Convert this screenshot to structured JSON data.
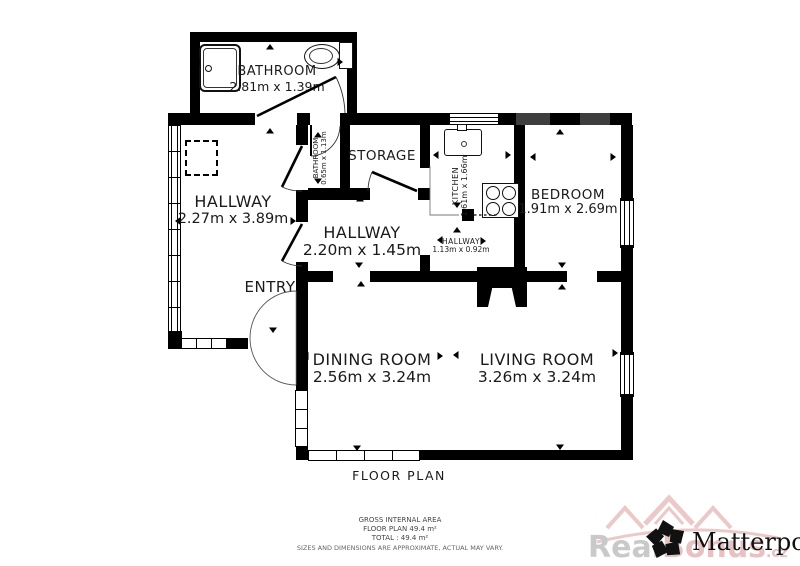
{
  "title": "FLOOR PLAN",
  "rooms": {
    "bathroom_top": {
      "name": "BATHROOM",
      "dims": "2.81m x 1.39m"
    },
    "hallway_left": {
      "name": "HALLWAY",
      "dims": "2.27m x 3.89m"
    },
    "bathroom_small": {
      "name": "BATHROOM",
      "dims": "0.65m x 1.13m"
    },
    "storage": {
      "name": "STORAGE",
      "dims": ""
    },
    "kitchen": {
      "name": "KITCHEN",
      "dims": "1.61m x 1.66m"
    },
    "bedroom": {
      "name": "BEDROOM",
      "dims": "1.91m x 2.69m"
    },
    "hallway_mid": {
      "name": "HALLWAY",
      "dims": "2.20m x 1.45m"
    },
    "hallway_small": {
      "name": "HALLWAY",
      "dims": "1.13m x 0.92m"
    },
    "entry": {
      "name": "ENTRY",
      "dims": ""
    },
    "dining": {
      "name": "DINING ROOM",
      "dims": "2.56m x 3.24m"
    },
    "living": {
      "name": "LIVING ROOM",
      "dims": "3.26m x 3.24m"
    }
  },
  "footer": {
    "line1": "GROSS INTERNAL AREA",
    "line2": "FLOOR PLAN 49.4 m²",
    "line3": "TOTAL :  49.4 m²",
    "line4": "SIZES AND DIMENSIONS ARE APPROXIMATE, ACTUAL MAY VARY."
  },
  "branding": {
    "logo_text": "Matterport",
    "registered": "®",
    "watermark_gray": "Real",
    "watermark_pink": "Bonus",
    "watermark_suffix": ".cz"
  },
  "colors": {
    "wall": "#000000",
    "watermark_pink": "#e8c2c2",
    "watermark_gray": "#c9c9c9"
  }
}
